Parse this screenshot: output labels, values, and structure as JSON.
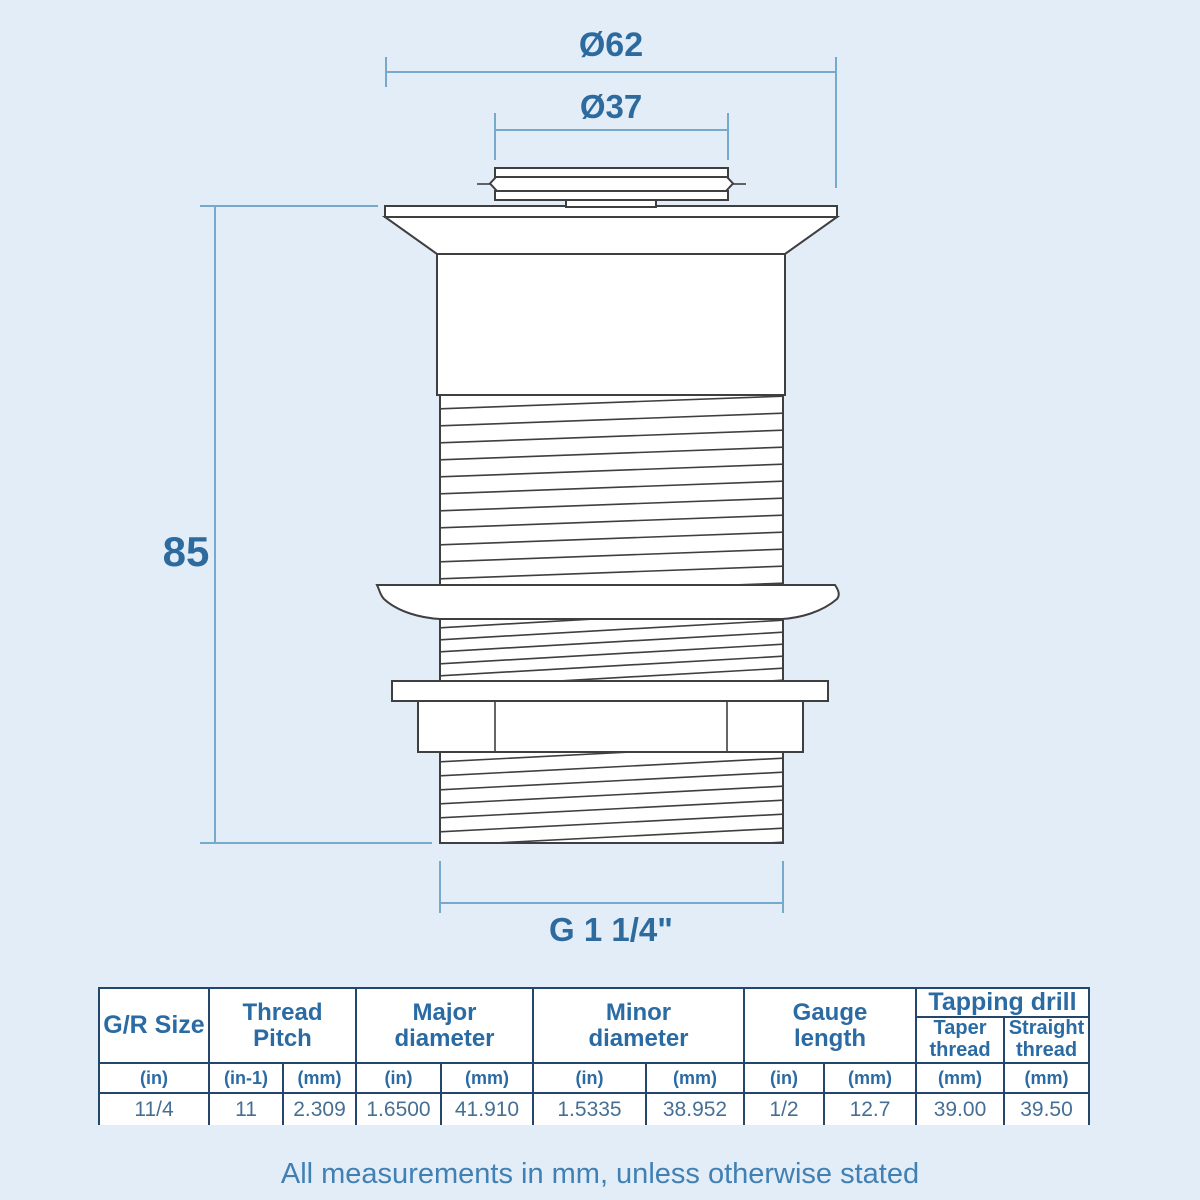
{
  "drawing": {
    "labels": {
      "outer_diameter": "Ø62",
      "inner_diameter": "Ø37",
      "overall_height": "85",
      "thread_size": "G 1 1/4\""
    }
  },
  "spec_table": {
    "headers": {
      "gr_size": "G/R Size",
      "thread_pitch": "Thread Pitch",
      "major_diameter": "Major diameter",
      "minor_diameter": "Minor diameter",
      "gauge_length": "Gauge length",
      "tapping_drill": "Tapping drill",
      "taper_thread": "Taper thread",
      "straight_thread": "Straight thread"
    },
    "units": [
      "(in)",
      "(in-1)",
      "(mm)",
      "(in)",
      "(mm)",
      "(in)",
      "(mm)",
      "(in)",
      "(mm)",
      "(mm)",
      "(mm)"
    ],
    "values": [
      "11/4",
      "11",
      "2.309",
      "1.6500",
      "41.910",
      "1.5335",
      "38.952",
      "1/2",
      "12.7",
      "39.00",
      "39.50"
    ]
  },
  "footer": {
    "note": "All measurements in mm, unless otherwise stated"
  },
  "colors": {
    "background": "#e3edf8",
    "drawing_outline": "#3f3f3f",
    "dimension_line": "#76a9cc",
    "dimension_text": "#2d6b9e",
    "table_border": "#24466b",
    "table_header_text": "#2b6ba3",
    "table_value_text": "#476f94",
    "footer_text": "#4080b3"
  }
}
